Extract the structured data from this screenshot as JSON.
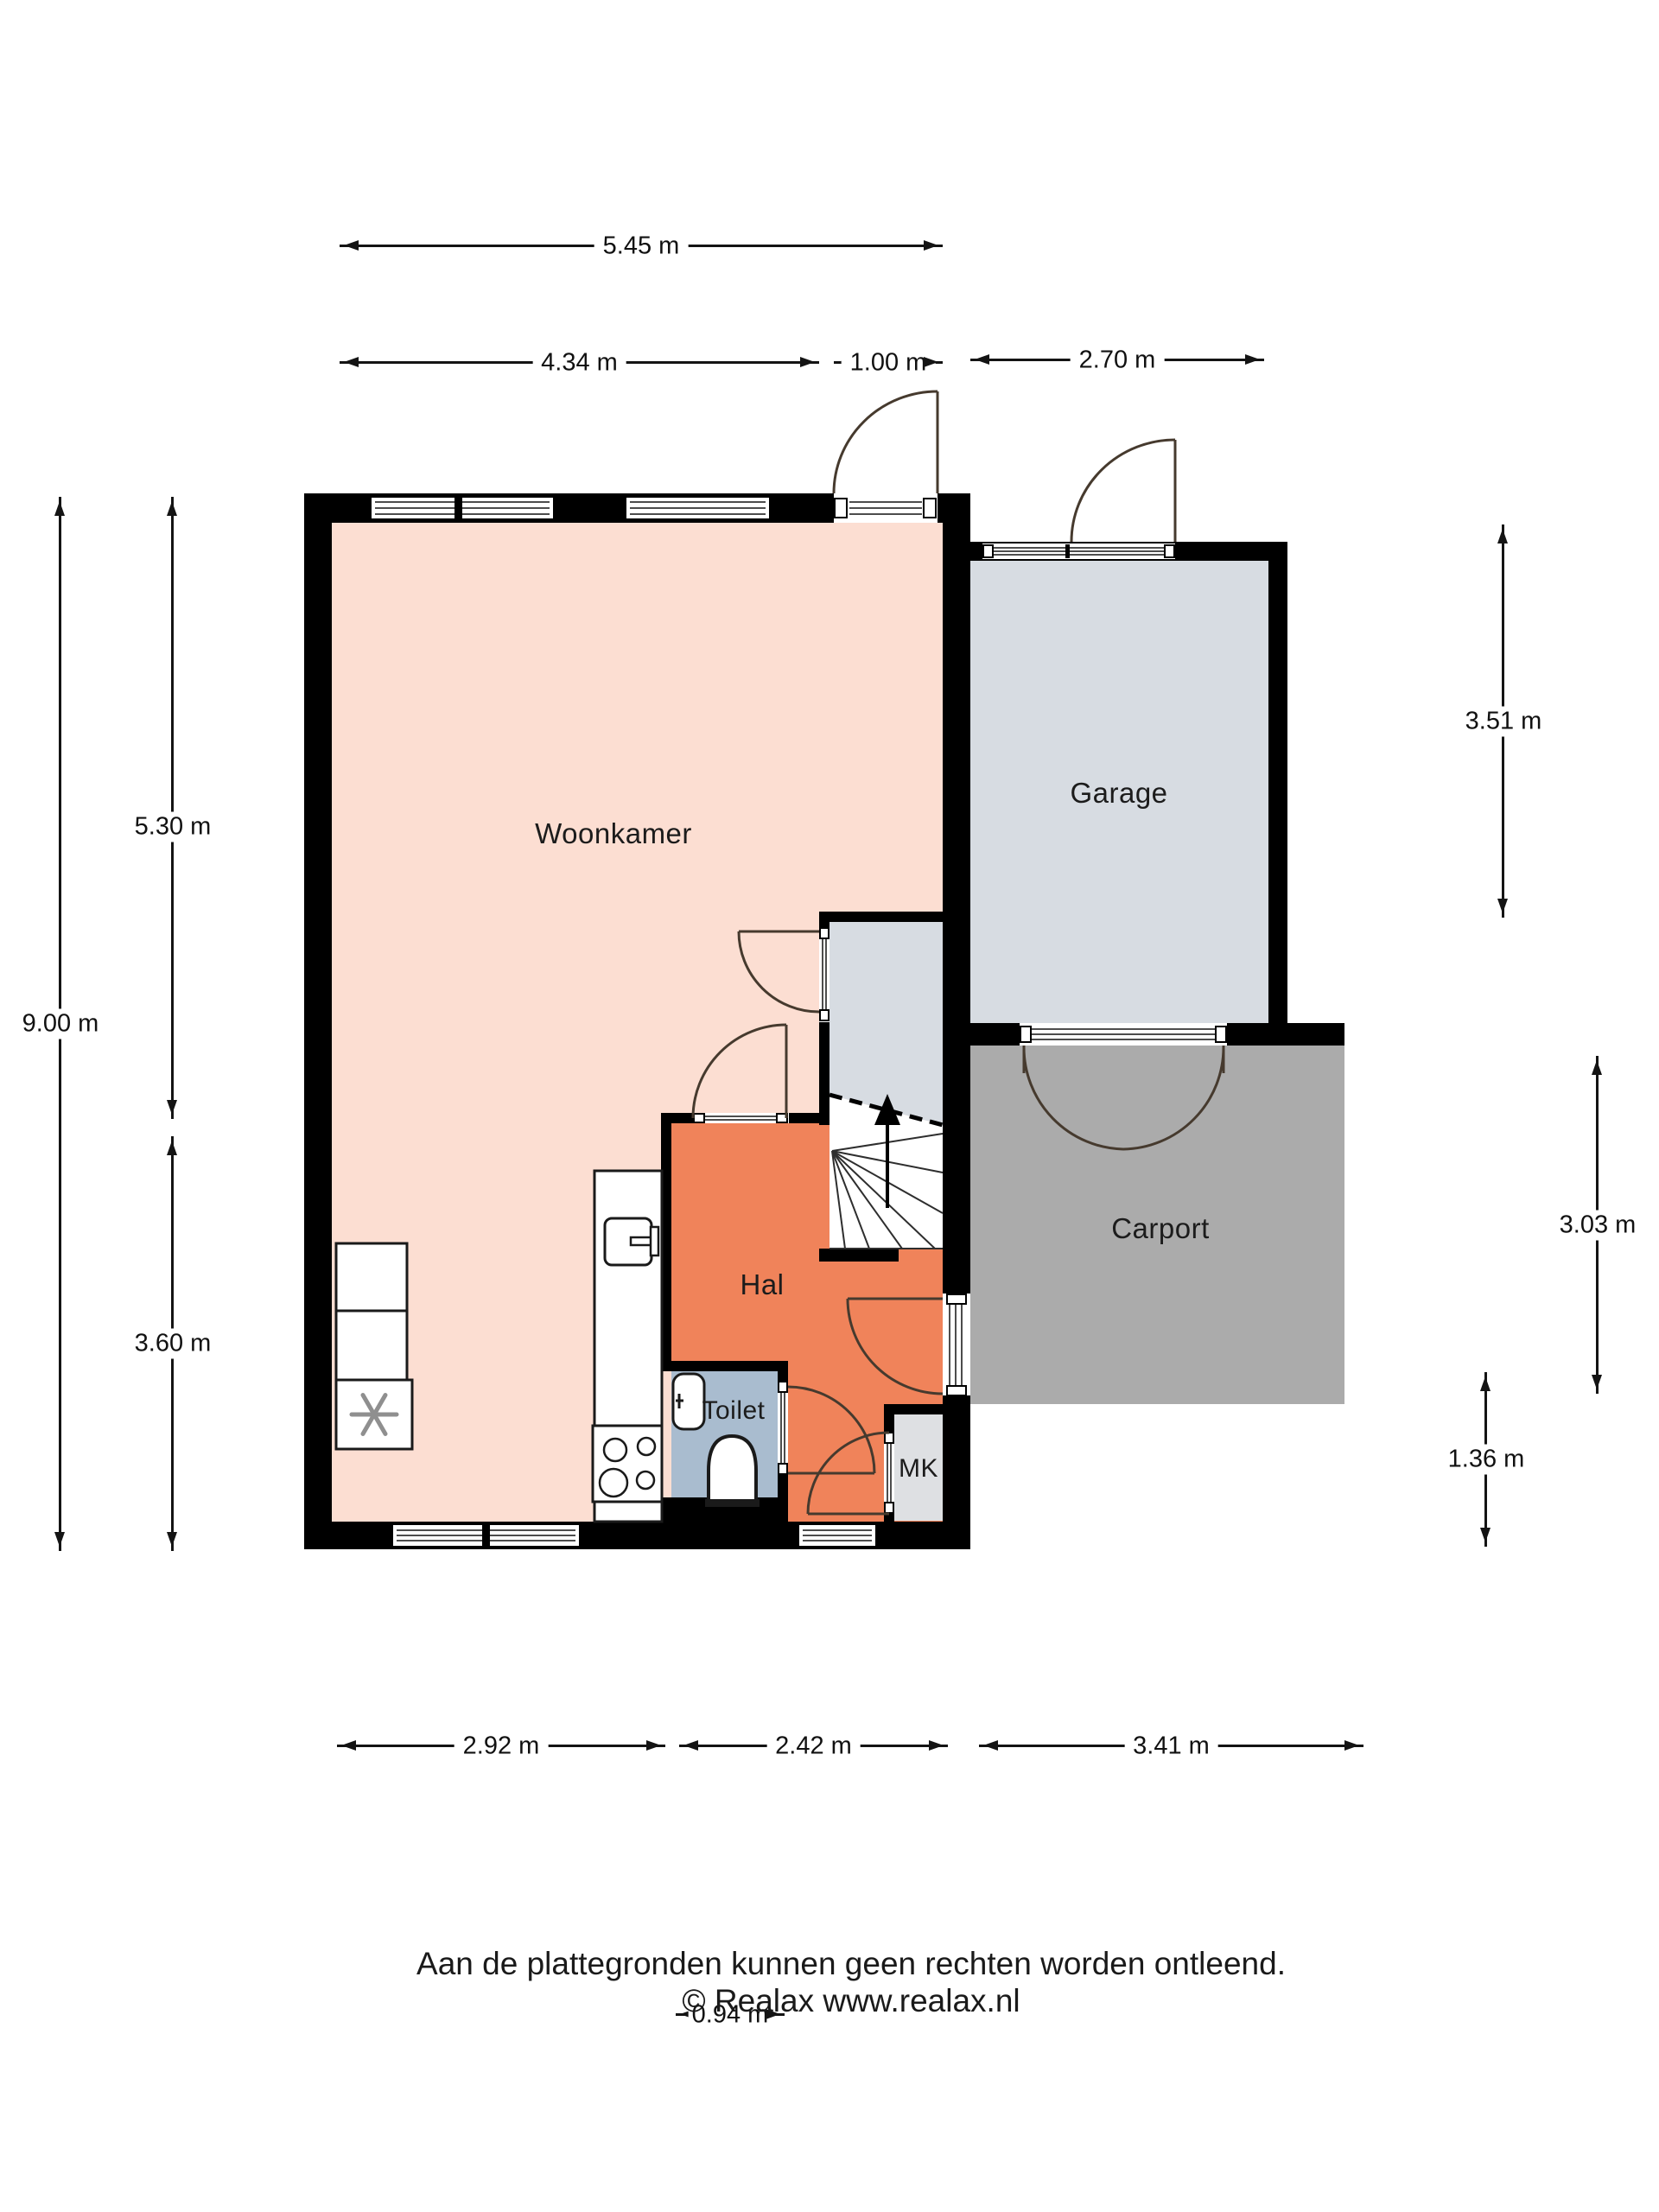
{
  "rooms": {
    "woonkamer": "Woonkamer",
    "garage": "Garage",
    "carport": "Carport",
    "hal": "Hal",
    "toilet": "Toilet",
    "mk": "MK"
  },
  "dims": {
    "d545": "5.45 m",
    "d434": "4.34 m",
    "d100": "1.00 m",
    "d270": "2.70 m",
    "d900": "9.00 m",
    "d530": "5.30 m",
    "d360": "3.60 m",
    "d351": "3.51 m",
    "d303": "3.03 m",
    "d136": "1.36 m",
    "d292": "2.92 m",
    "d242": "2.42 m",
    "d341": "3.41 m",
    "d094": "0.94 m"
  },
  "footer": {
    "line1": "Aan de plattegronden kunnen geen rechten worden ontleend.",
    "line2": "© Realax www.realax.nl"
  },
  "colors": {
    "wall": "#000000",
    "woonkamer_fill": "#fcded2",
    "hal_fill": "#f0835a",
    "toilet_fill": "#a9bccf",
    "mk_fill": "#dee0e3",
    "garage_fill": "#d7dce2",
    "carport_fill": "#ababab",
    "door_arc": "#463a2e"
  }
}
